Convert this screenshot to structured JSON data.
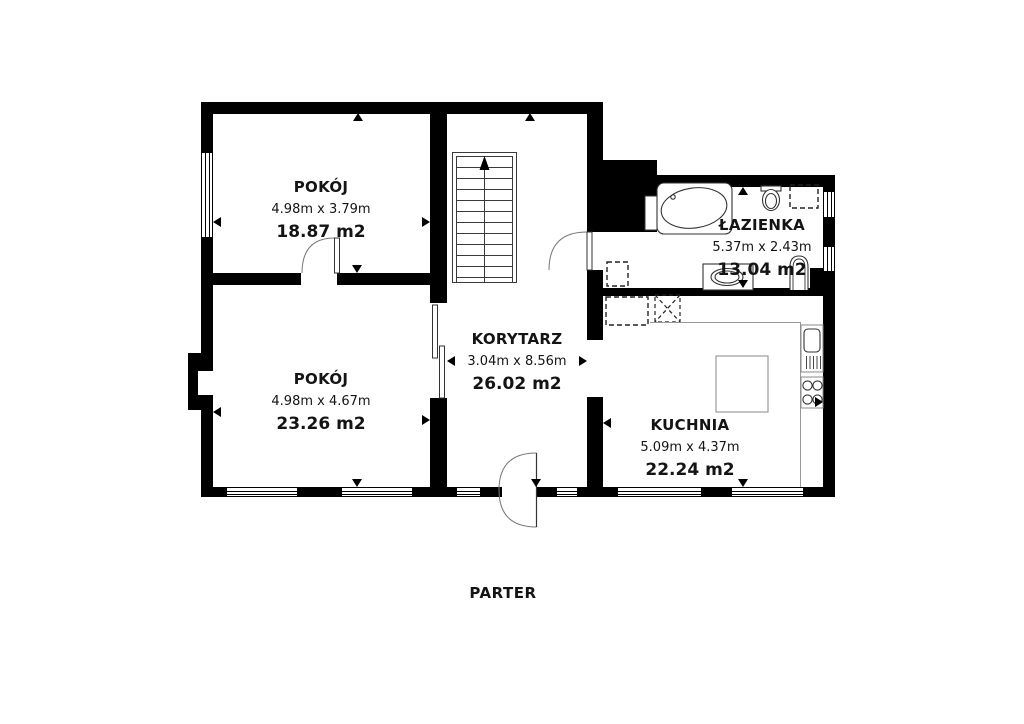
{
  "floor_title": "PARTER",
  "rooms": [
    {
      "name": "POKÓJ",
      "dimensions": "4.98m x 3.79m",
      "area": "18.87 m2"
    },
    {
      "name": "POKÓJ",
      "dimensions": "4.98m x 4.67m",
      "area": "23.26 m2"
    },
    {
      "name": "KORYTARZ",
      "dimensions": "3.04m x 8.56m",
      "area": "26.02 m2"
    },
    {
      "name": "ŁAZIENKA",
      "dimensions": "5.37m x 2.43m",
      "area": "13.04 m2"
    },
    {
      "name": "KUCHNIA",
      "dimensions": "5.09m x 4.37m",
      "area": "22.24 m2"
    }
  ],
  "colors": {
    "wall": "#000000",
    "background": "#ffffff",
    "fixture_stroke": "#333333",
    "counter_stroke": "#999999"
  }
}
